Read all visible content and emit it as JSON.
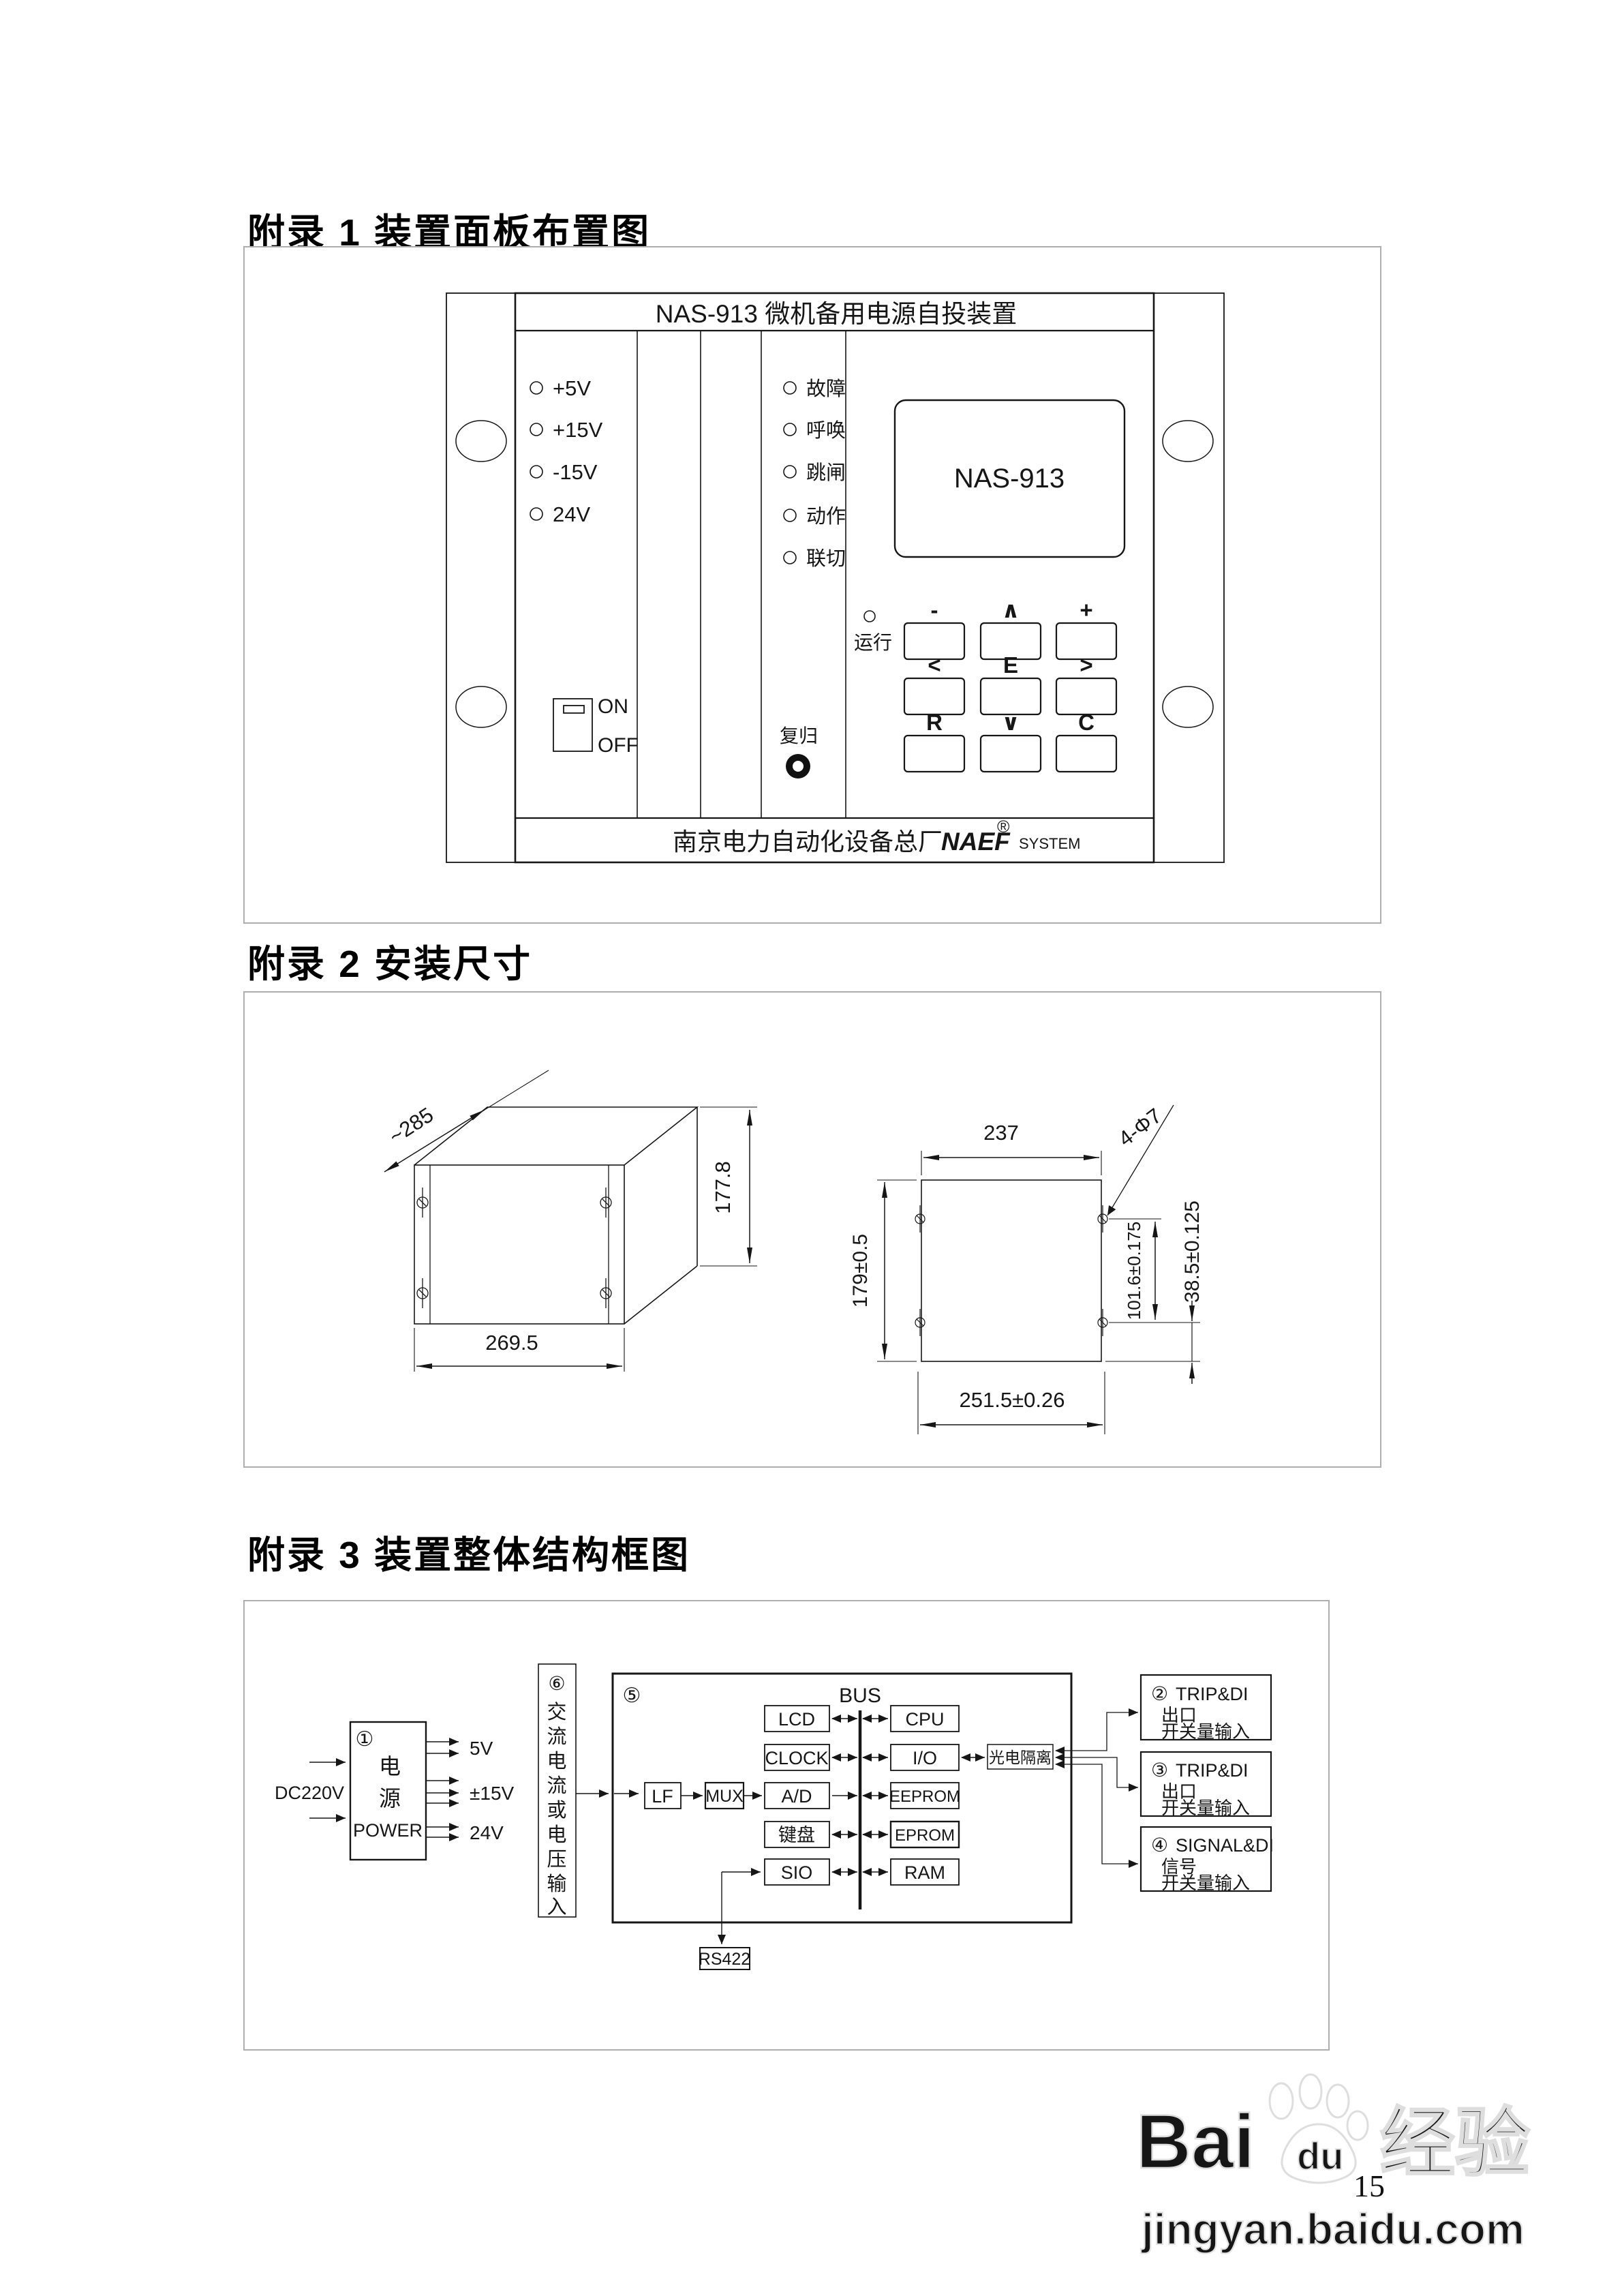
{
  "page": {
    "number": "15"
  },
  "watermark": {
    "brand_latin": "Bai",
    "brand_du": "du",
    "brand_cn": "经验",
    "url": "jingyan.baidu.com"
  },
  "appendix1": {
    "title": "附录 1  装置面板布置图",
    "panel_title": "NAS-913 微机备用电源自投装置",
    "power_leds": [
      "+5V",
      "+15V",
      "-15V",
      "24V"
    ],
    "status_leds": [
      "故障",
      "呼唤",
      "跳闸",
      "动作",
      "联切"
    ],
    "run_led": "运行",
    "lcd_text": "NAS-913",
    "keypad": [
      [
        "-",
        "∧",
        "+"
      ],
      [
        "<",
        "E",
        ">"
      ],
      [
        "R",
        "∨",
        "C"
      ]
    ],
    "switch_on": "ON",
    "switch_off": "OFF",
    "reset_label": "复归",
    "footer_cn": "南京电力自动化设备总厂",
    "footer_brand": "NAEF",
    "footer_reg": "®",
    "footer_system": "SYSTEM"
  },
  "appendix2": {
    "title": "附录 2  安装尺寸",
    "left": {
      "depth": "~285",
      "height": "177.8",
      "width": "269.5"
    },
    "right": {
      "width_top": "237",
      "holes": "4-Φ7",
      "height_left": "179±0.5",
      "hole_span_v": "101.6±0.175",
      "edge_offset": "38.5±0.125",
      "width_bottom": "251.5±0.26"
    }
  },
  "appendix3": {
    "title": "附录 3  装置整体结构框图",
    "power": {
      "num": "①",
      "cn1": "电",
      "cn2": "源",
      "en": "POWER",
      "input": "DC220V",
      "out1": "5V",
      "out2": "±15V",
      "out3": "24V"
    },
    "ac": {
      "num": "⑥",
      "c0": "交",
      "c1": "流",
      "c2": "电",
      "c3": "流",
      "c4": "或",
      "c5": "电",
      "c6": "压",
      "c7": "输",
      "c8": "入"
    },
    "main": {
      "num": "⑤",
      "bus": "BUS",
      "left_boxes": [
        "LCD",
        "CLOCK",
        "A/D",
        "键盘",
        "SIO"
      ],
      "right_boxes": [
        "CPU",
        "I/O",
        "EEPROM",
        "EPROM",
        "RAM"
      ],
      "lf": "LF",
      "mux": "MUX",
      "iso": "光电隔离",
      "rs422": "RS422"
    },
    "io_boxes": [
      {
        "num": "②",
        "line1": "TRIP&DI",
        "line2": "出口",
        "line3": "开关量输入"
      },
      {
        "num": "③",
        "line1": "TRIP&DI",
        "line2": "出口",
        "line3": "开关量输入"
      },
      {
        "num": "④",
        "line1": "SIGNAL&DI",
        "line2": "信号",
        "line3": "开关量输入"
      }
    ]
  }
}
